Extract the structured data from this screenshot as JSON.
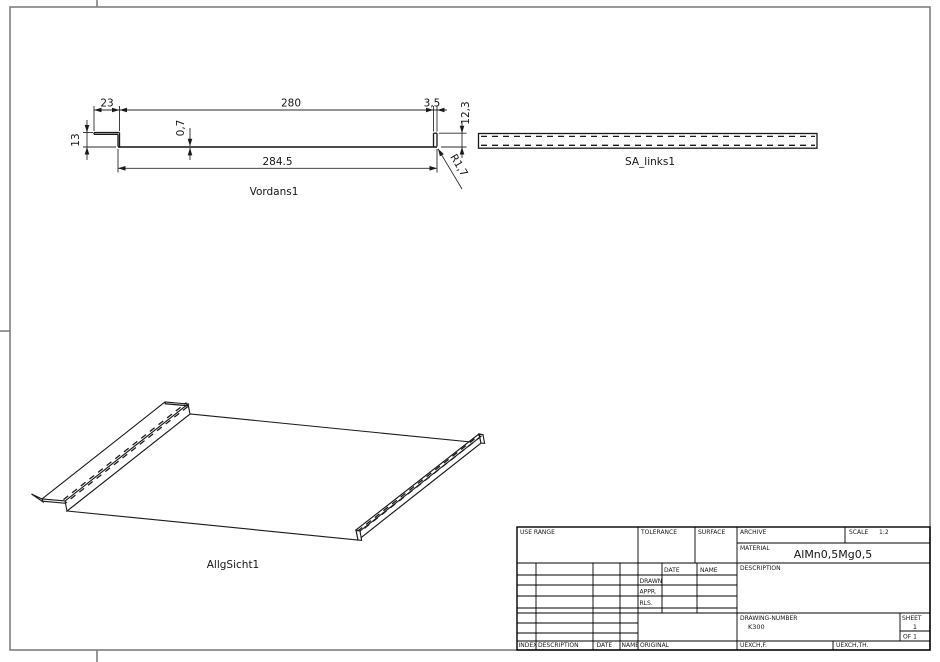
{
  "front_view": {
    "label": "Vordans1",
    "dims": {
      "lip_width": "23",
      "top_width": "280",
      "hem_width": "3,5",
      "hem_height": "12,3",
      "lip_height": "13",
      "thickness": "0,7",
      "total_length": "284.5",
      "radius": "R1,7"
    }
  },
  "side_view": {
    "label": "SA_links1"
  },
  "iso_view": {
    "label": "AllgSicht1"
  },
  "title_block": {
    "use_range_label": "USE RANGE",
    "tolerance_label": "TOLERANCE",
    "surface_label": "SURFACE",
    "archive_label": "ARCHIVE",
    "scale_label": "SCALE",
    "scale_value": "1:2",
    "material_label": "MATERIAL",
    "material_value": "AlMn0,5Mg0,5",
    "date_label": "DATE",
    "name_label": "NAME",
    "description_label": "DESCRIPTION",
    "drawn_label": "DRAWN",
    "appr_label": "APPR.",
    "rls_label": "RLS.",
    "drawing_number_label": "DRAWING-NUMBER",
    "drawing_number_value": "K300",
    "sheet_label": "SHEET",
    "sheet_value": "1",
    "of_label": "OF 1",
    "footer": {
      "index": "INDEX",
      "description": "DESCRIPTION",
      "date": "DATE",
      "name": "NAME",
      "original": "ORIGINAL",
      "uexch_f": "UEXCH,F.",
      "uexch_th": "UEXCH,TH."
    }
  },
  "colors": {
    "line": "#1a1a1a",
    "frame": "#7f7f7f",
    "background": "#ffffff"
  }
}
